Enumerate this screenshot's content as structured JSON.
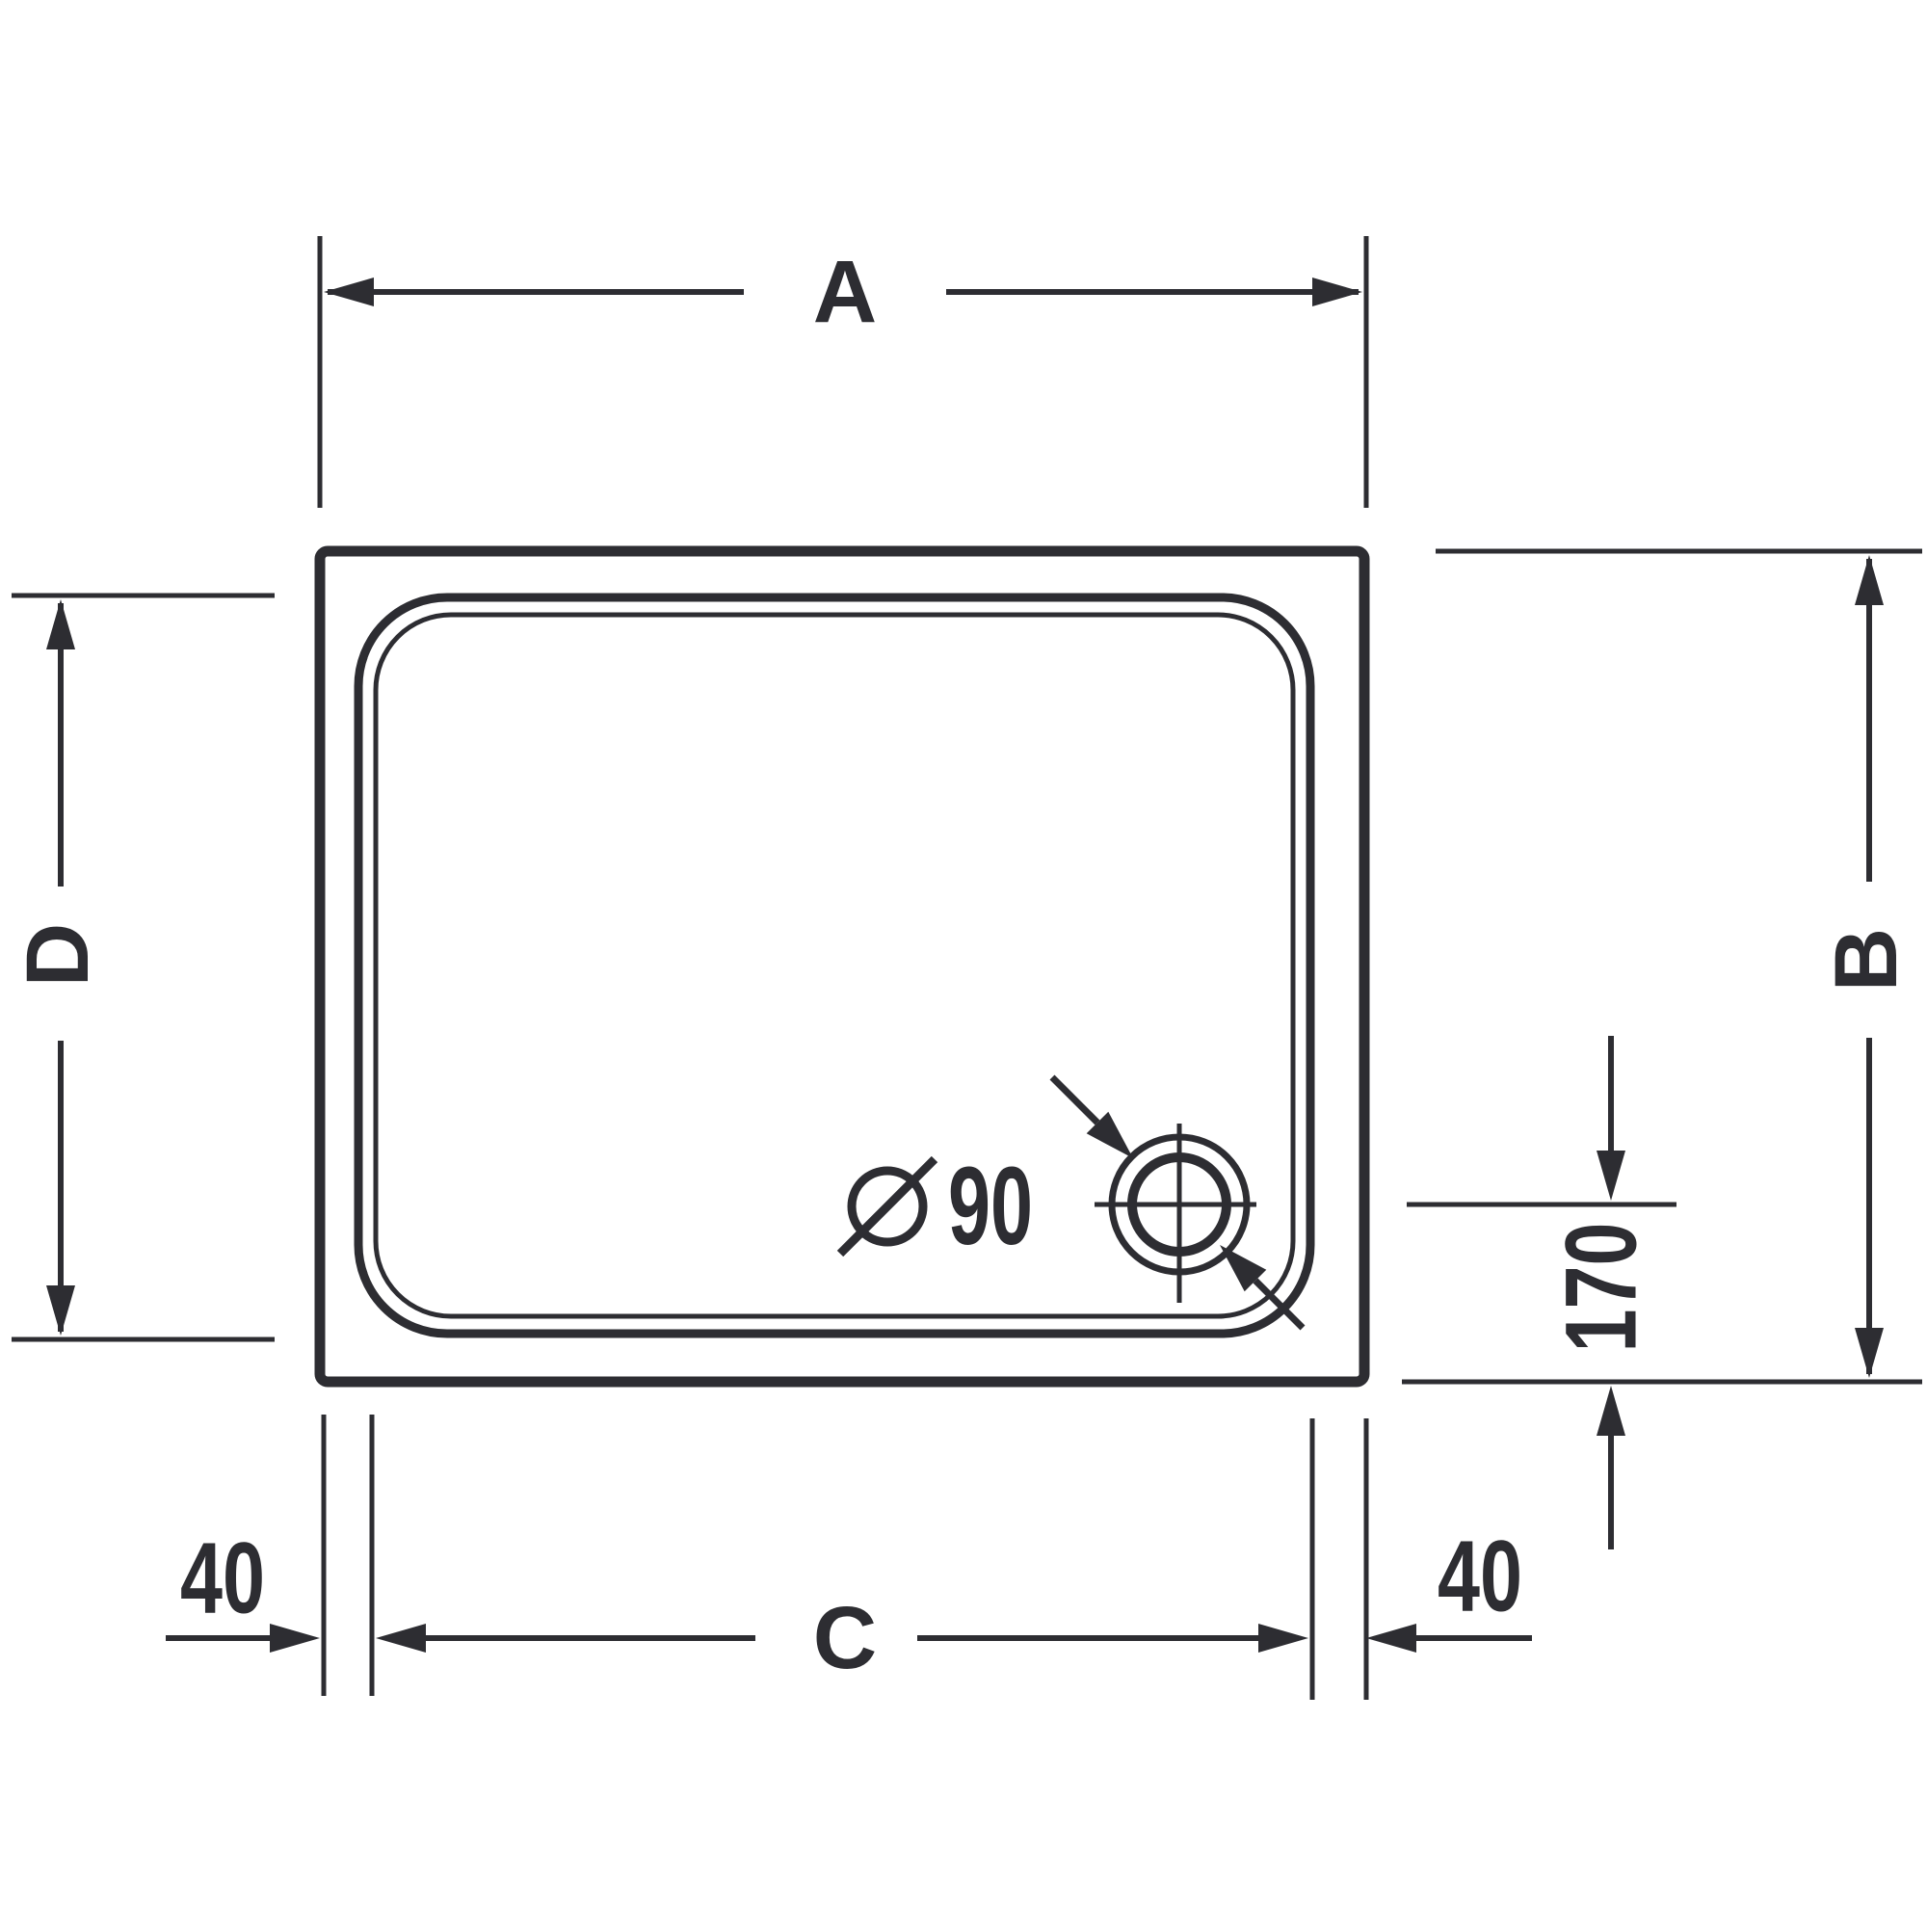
{
  "diagram": {
    "type": "technical-drawing",
    "title": "Rectangular shower tray - dimensional drawing (top view)",
    "labels": {
      "dim_width_overall": "A",
      "dim_height_overall": "B",
      "dim_width_inner": "C",
      "dim_height_inner": "D",
      "offset_left": "40",
      "offset_right": "40",
      "drain_offset_from_bottom": "170",
      "drain_diameter_value": "90",
      "drain_diameter_full": "Ø 90"
    },
    "colors": {
      "line": "#2d2d32",
      "background": "#ffffff"
    }
  }
}
